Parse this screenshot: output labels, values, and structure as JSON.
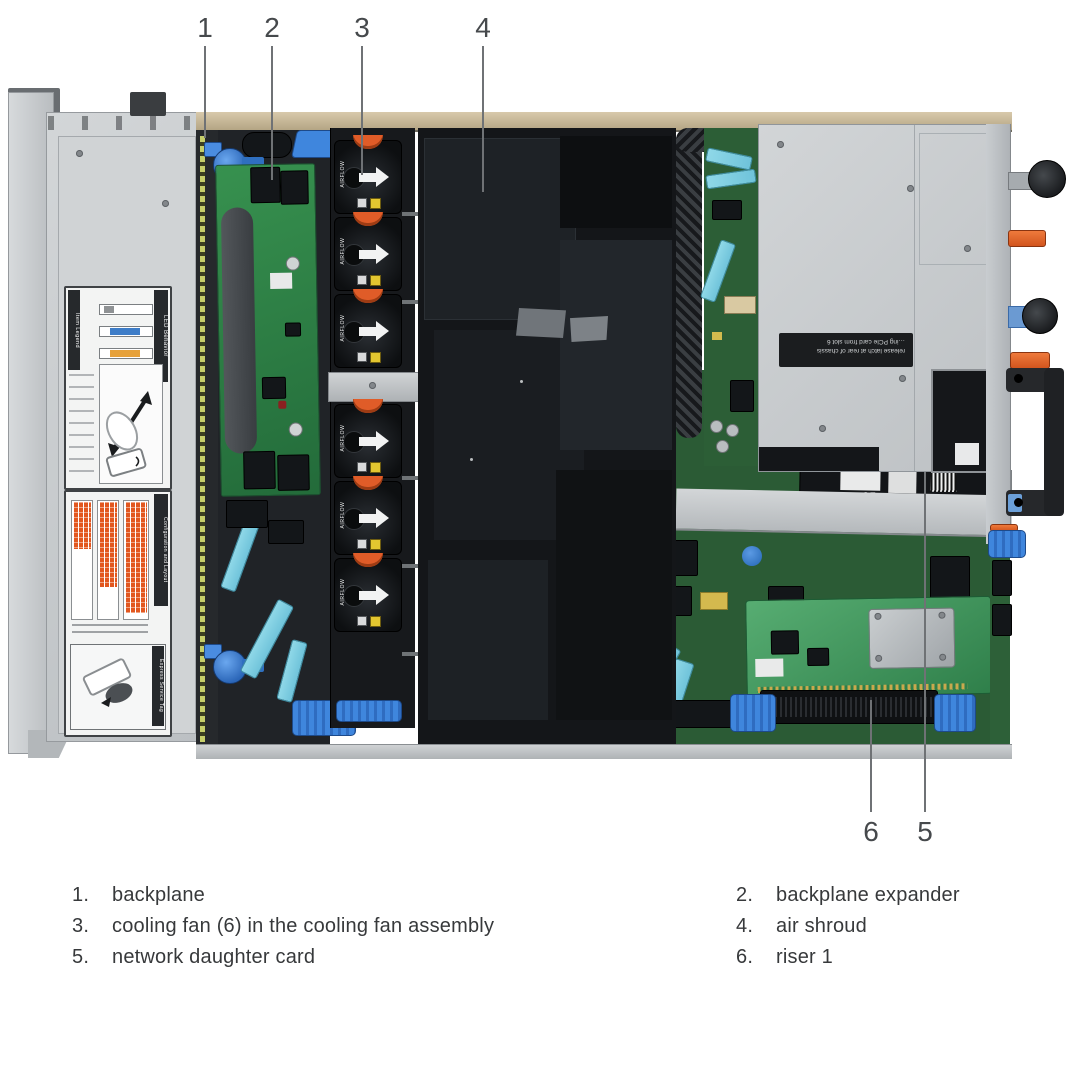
{
  "figure": {
    "description": "server interior top view with numbered callouts",
    "callouts": {
      "top": [
        {
          "num": "1",
          "target": "backplane"
        },
        {
          "num": "2",
          "target": "backplane expander"
        },
        {
          "num": "3",
          "target": "cooling fan"
        },
        {
          "num": "4",
          "target": "air shroud"
        }
      ],
      "bottom": [
        {
          "num": "6",
          "target": "riser 1"
        },
        {
          "num": "5",
          "target": "network daughter card"
        }
      ]
    }
  },
  "legend": {
    "items": [
      {
        "number": "1.",
        "text": "backplane"
      },
      {
        "number": "2.",
        "text": "backplane expander"
      },
      {
        "number": "3.",
        "text": "cooling fan (6) in the cooling fan assembly"
      },
      {
        "number": "4.",
        "text": "air shroud"
      },
      {
        "number": "5.",
        "text": "network daughter card"
      },
      {
        "number": "6.",
        "text": "riser 1"
      }
    ]
  },
  "server": {
    "stickers": {
      "led_behavior": "LED Behavior",
      "item_legend": "Item Legend",
      "config_layout": "Configuration and Layout",
      "express_service_tag": "Express Service Tag"
    },
    "fan_assembly": {
      "airflow_label": "AIRFLOW",
      "fan_count": 6
    },
    "psu_cage_label": {
      "line1": "release latch at rear of chassis",
      "line2": "…ing PCIe card from slot 6"
    },
    "ndc_ce_mark": "CE"
  },
  "colors": {
    "pcb_green": "#2F8048",
    "pcb_light_green": "#4FA968",
    "latch_blue": "#3F86DD",
    "accent_orange": "#E0662C",
    "warning_yellow": "#E3C630",
    "cable_cyan": "#7FD0E2",
    "chassis_metal": "#C9CCCE",
    "shroud_black": "#17191C",
    "bezel_tan": "#C9B897",
    "leader_gray": "#6F7275",
    "text_dark": "#3A3D40"
  }
}
